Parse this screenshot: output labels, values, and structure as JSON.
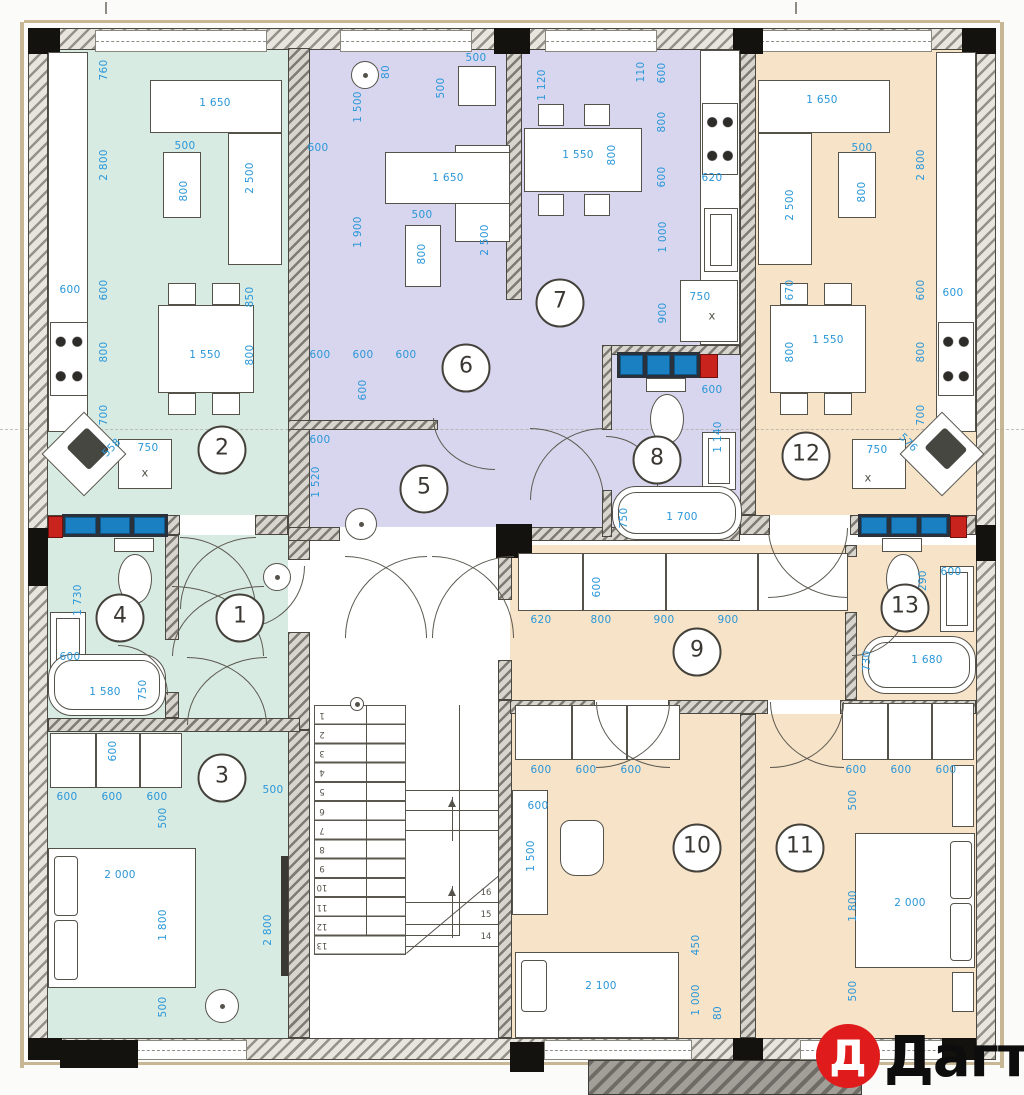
{
  "watermark": {
    "letter": "Д",
    "text": "Дагти"
  },
  "rooms": [
    "1",
    "2",
    "3",
    "4",
    "5",
    "6",
    "7",
    "8",
    "9",
    "10",
    "11",
    "12",
    "13"
  ],
  "stairs": {
    "left": [
      "1",
      "2",
      "3",
      "4",
      "5",
      "6",
      "7",
      "8",
      "9",
      "10",
      "11",
      "12",
      "13"
    ],
    "right": [
      "16",
      "15",
      "14"
    ]
  },
  "dims": [
    "760",
    "2 800",
    "1 650",
    "500",
    "800",
    "2 500",
    "600",
    "600",
    "800",
    "1 550",
    "850",
    "800",
    "700",
    "558",
    "750",
    "x",
    "1 730",
    "600",
    "1 580",
    "750",
    "600",
    "600",
    "600",
    "600",
    "500",
    "2 000",
    "1 800",
    "500",
    "500",
    "2 800",
    "1 500",
    "80",
    "500",
    "500",
    "600",
    "1 650",
    "1 900",
    "500",
    "800",
    "2 500",
    "600",
    "600",
    "600",
    "600",
    "600",
    "1 520",
    "1 120",
    "110",
    "1 550",
    "800",
    "600",
    "800",
    "600",
    "620",
    "1 000",
    "900",
    "750",
    "x",
    "600",
    "1 140",
    "750",
    "1 700",
    "1 650",
    "2 800",
    "500",
    "800",
    "2 500",
    "670",
    "600",
    "600",
    "800",
    "1 550",
    "800",
    "700",
    "576",
    "750",
    "x",
    "600",
    "620",
    "800",
    "900",
    "900",
    "1 290",
    "600",
    "730",
    "1 680",
    "600",
    "600",
    "600",
    "600",
    "1 500",
    "450",
    "1 000",
    "80",
    "2 100",
    "600",
    "600",
    "600",
    "500",
    "1 800",
    "2 000",
    "500"
  ],
  "colors": {
    "apartment_left": "#d7ebe3",
    "apartment_middle": "#d8d6ee",
    "apartment_right": "#f7e3c8",
    "dimension_blue": "#2a96d8",
    "tile_blue": "#1b80c2",
    "logo_red": "#e01b1b"
  }
}
